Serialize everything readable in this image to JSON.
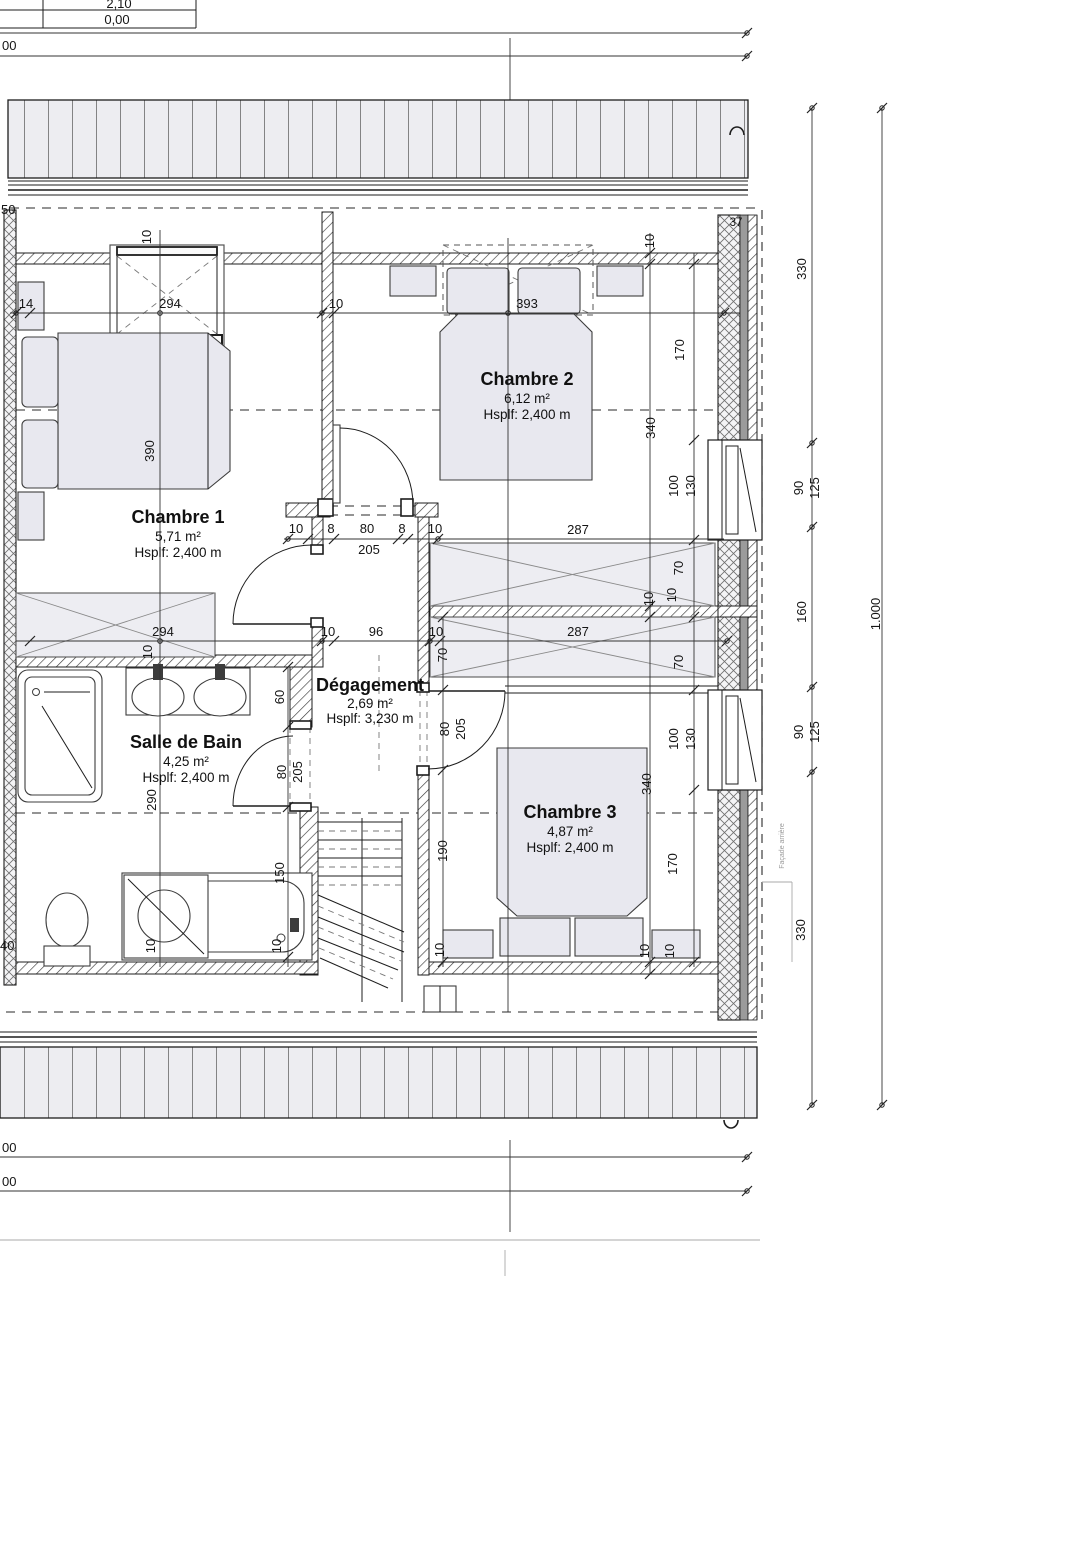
{
  "drawing": {
    "levels_table": {
      "row1": "2,10",
      "row2": "0,00"
    },
    "overall_dims": {
      "top": "00",
      "bottom1": "00",
      "bottom2": "00",
      "left_top": "50",
      "left_bottom": "40"
    }
  },
  "rooms": {
    "chambre1": {
      "name": "Chambre 1",
      "area": "5,71 m²",
      "height": "Hsplf: 2,400 m"
    },
    "chambre2": {
      "name": "Chambre 2",
      "area": "6,12 m²",
      "height": "Hsplf: 2,400 m"
    },
    "chambre3": {
      "name": "Chambre 3",
      "area": "4,87 m²",
      "height": "Hsplf: 2,400 m"
    },
    "salle_de_bain": {
      "name": "Salle de Bain",
      "area": "4,25 m²",
      "height": "Hsplf: 2,400 m"
    },
    "degagement": {
      "name": "Dégagement",
      "area": "2,69 m²",
      "height": "Hsplf: 3,230 m"
    }
  },
  "annotations": {
    "facade_note": "Façade arrière",
    "wall_thickness": "37"
  },
  "dims": {
    "w14": "14",
    "w294": "294",
    "w10_part": "10",
    "w393": "393",
    "door1_10l": "10",
    "door1_8l": "8",
    "door1_80": "80",
    "door1_8r": "8",
    "door1_10r": "10",
    "door1_205": "205",
    "mid287_u": "287",
    "low294": "294",
    "low10a": "10",
    "low96": "96",
    "low10b": "10",
    "low287": "287",
    "v10_win1": "10",
    "v390": "390",
    "v10_h3": "10",
    "v290": "290",
    "v10_ax": "10",
    "v10_win2": "10",
    "v340_t": "340",
    "v10_c1": "10",
    "v340_b": "340",
    "v10_b1": "10",
    "v170_t": "170",
    "v100_t": "100",
    "v130_t": "130",
    "v70_t": "70",
    "v10_c2": "10",
    "v70_b": "70",
    "v100_b": "100",
    "v130_b": "130",
    "v170_b": "170",
    "v10_b2": "10",
    "v60": "60",
    "v80_sdb": "80",
    "v205_sdb": "205",
    "v150": "150",
    "v10_tub": "10",
    "v70_deg": "70",
    "v80_deg": "80",
    "v205_deg": "205",
    "v190": "190",
    "v10_deg": "10",
    "v330_t": "330",
    "v90_t": "90",
    "v125_t": "125",
    "v160": "160",
    "v90_b": "90",
    "v125_b": "125",
    "v330_b": "330",
    "v1000": "1.000"
  }
}
